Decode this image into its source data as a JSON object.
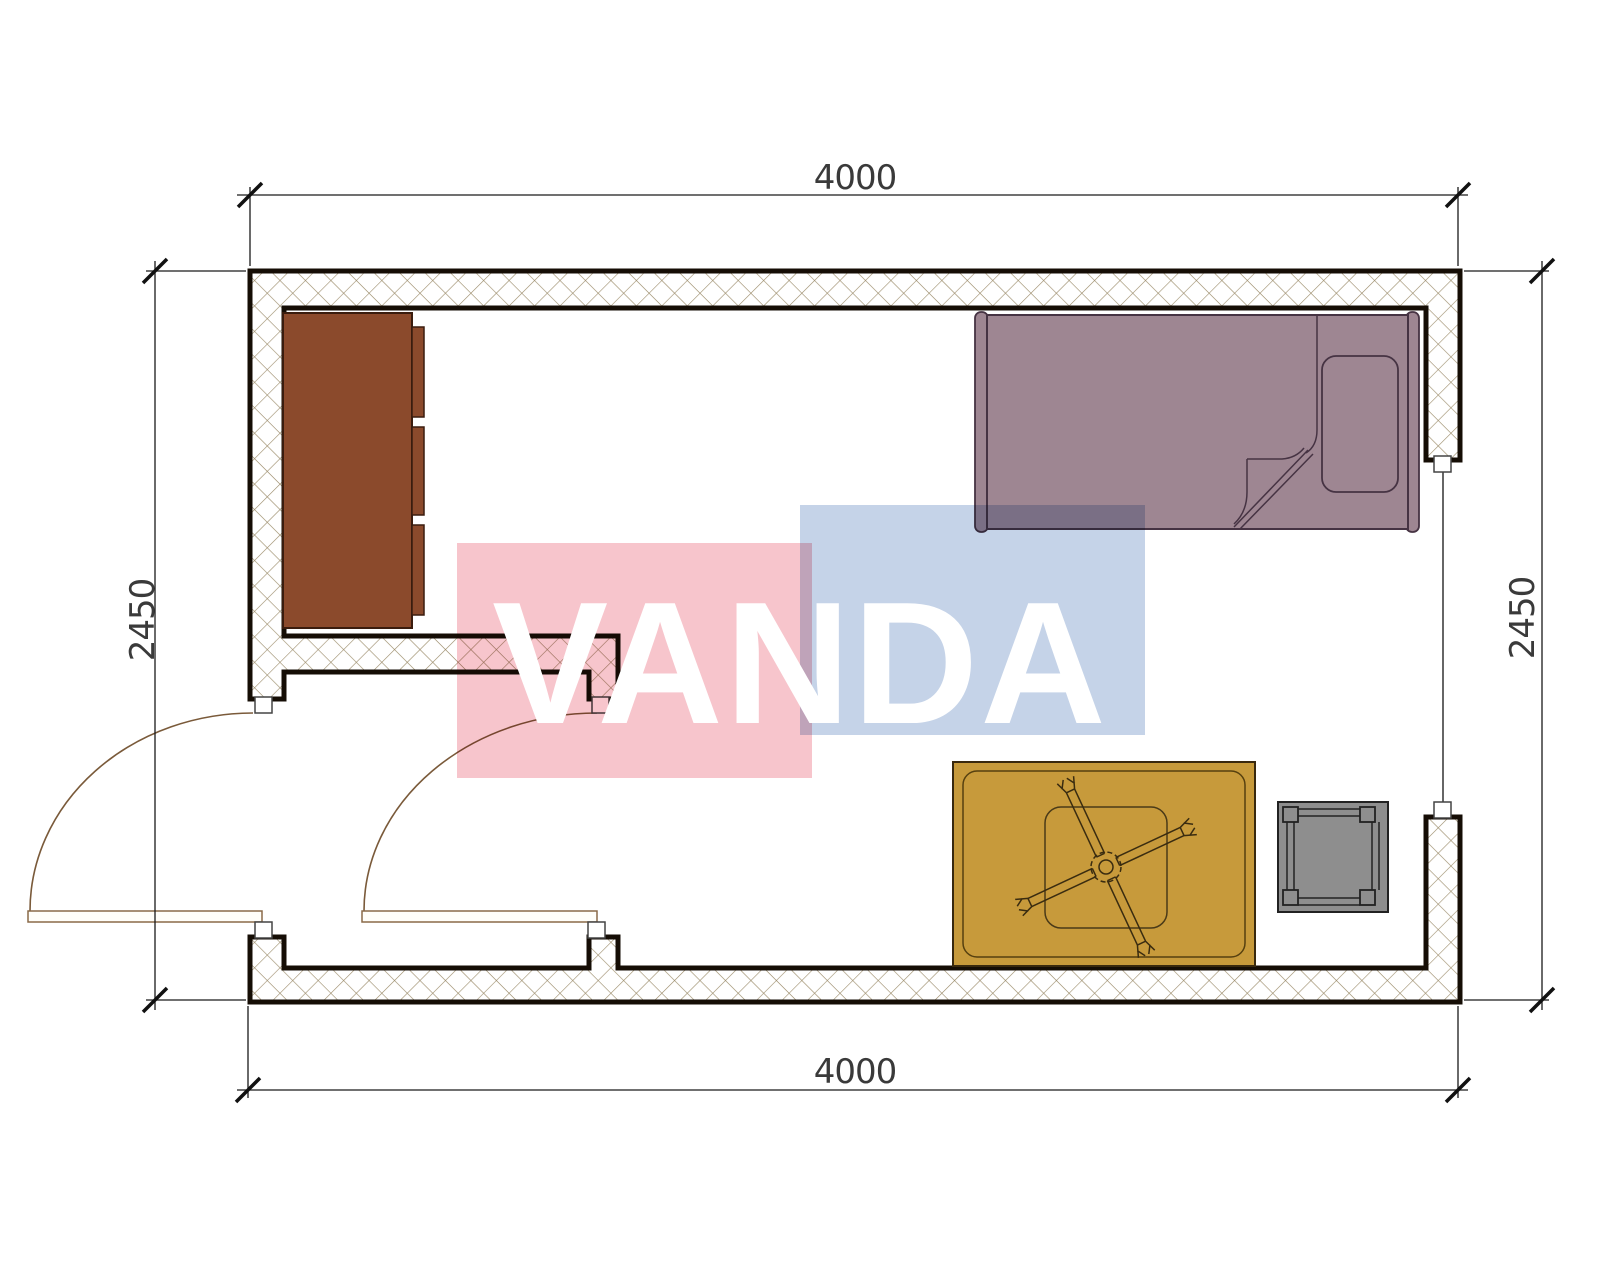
{
  "drawing": {
    "dimensions": {
      "top": "4000",
      "bottom": "4000",
      "left": "2450",
      "right": "2450"
    },
    "watermark": {
      "text": "VANDA",
      "pink_block": "#f7c5cc",
      "blue_block": "#c5d3e8",
      "text_color": "#ffffff"
    },
    "colors": {
      "wall_outline": "#150d05",
      "hatch_line": "#9a8a68",
      "cabinet": "#8b4a2c",
      "cabinet_border": "#3a1c0e",
      "bed": "#9e8692",
      "bed_border": "#463343",
      "rug": "#c79a3b",
      "rug_border": "#39290e",
      "table": "#8e8e8e",
      "table_border": "#222222",
      "door_line": "#7a5a3a",
      "dimension_line": "#1a1a1a"
    }
  }
}
